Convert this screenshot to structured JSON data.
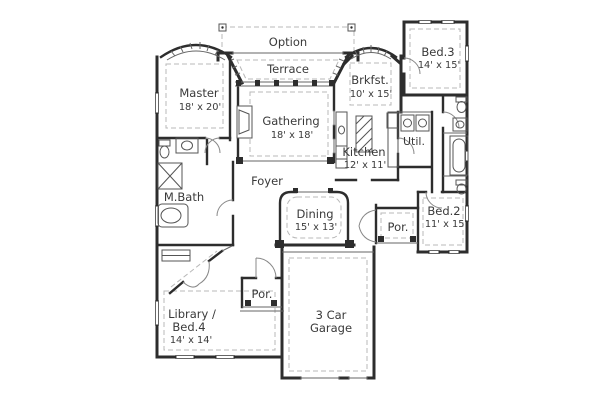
{
  "plan": {
    "background": "#ffffff",
    "colors": {
      "wall": "#2d2d2d",
      "thin_line": "#666666",
      "dashed": "#b8b8b8",
      "door_arc": "#888888",
      "fixture": "#555555",
      "text": "#3a3a3a"
    },
    "rooms": {
      "option": {
        "label": "Option"
      },
      "terrace": {
        "label": "Terrace"
      },
      "bed3": {
        "label": "Bed.3",
        "dims": "14' x 15'"
      },
      "master": {
        "label": "Master",
        "dims": "18' x 20'"
      },
      "brkfst": {
        "label": "Brkfst.",
        "dims": "10' x 15'"
      },
      "gathering": {
        "label": "Gathering",
        "dims": "18' x 18'"
      },
      "kitchen": {
        "label": "Kitchen",
        "dims": "12' x 11'"
      },
      "util": {
        "label": "Util."
      },
      "foyer": {
        "label": "Foyer"
      },
      "mbath": {
        "label": "M.Bath"
      },
      "dining": {
        "label": "Dining",
        "dims": "15' x 13'"
      },
      "porch_side": {
        "label": "Por."
      },
      "bed2": {
        "label": "Bed.2",
        "dims": "11' x 15'"
      },
      "library": {
        "label": "Library /",
        "label2": "Bed.4",
        "dims": "14' x 14'"
      },
      "porch_front": {
        "label": "Por."
      },
      "garage": {
        "label": "3 Car",
        "label2": "Garage"
      }
    },
    "fixtures": [
      "fireplace",
      "kitchen-island",
      "kitchen-sink",
      "range",
      "refrigerator",
      "washer",
      "dryer",
      "shower",
      "garden-tub",
      "toilet",
      "vanity-sink",
      "bathtub",
      "closet-shelf"
    ]
  }
}
